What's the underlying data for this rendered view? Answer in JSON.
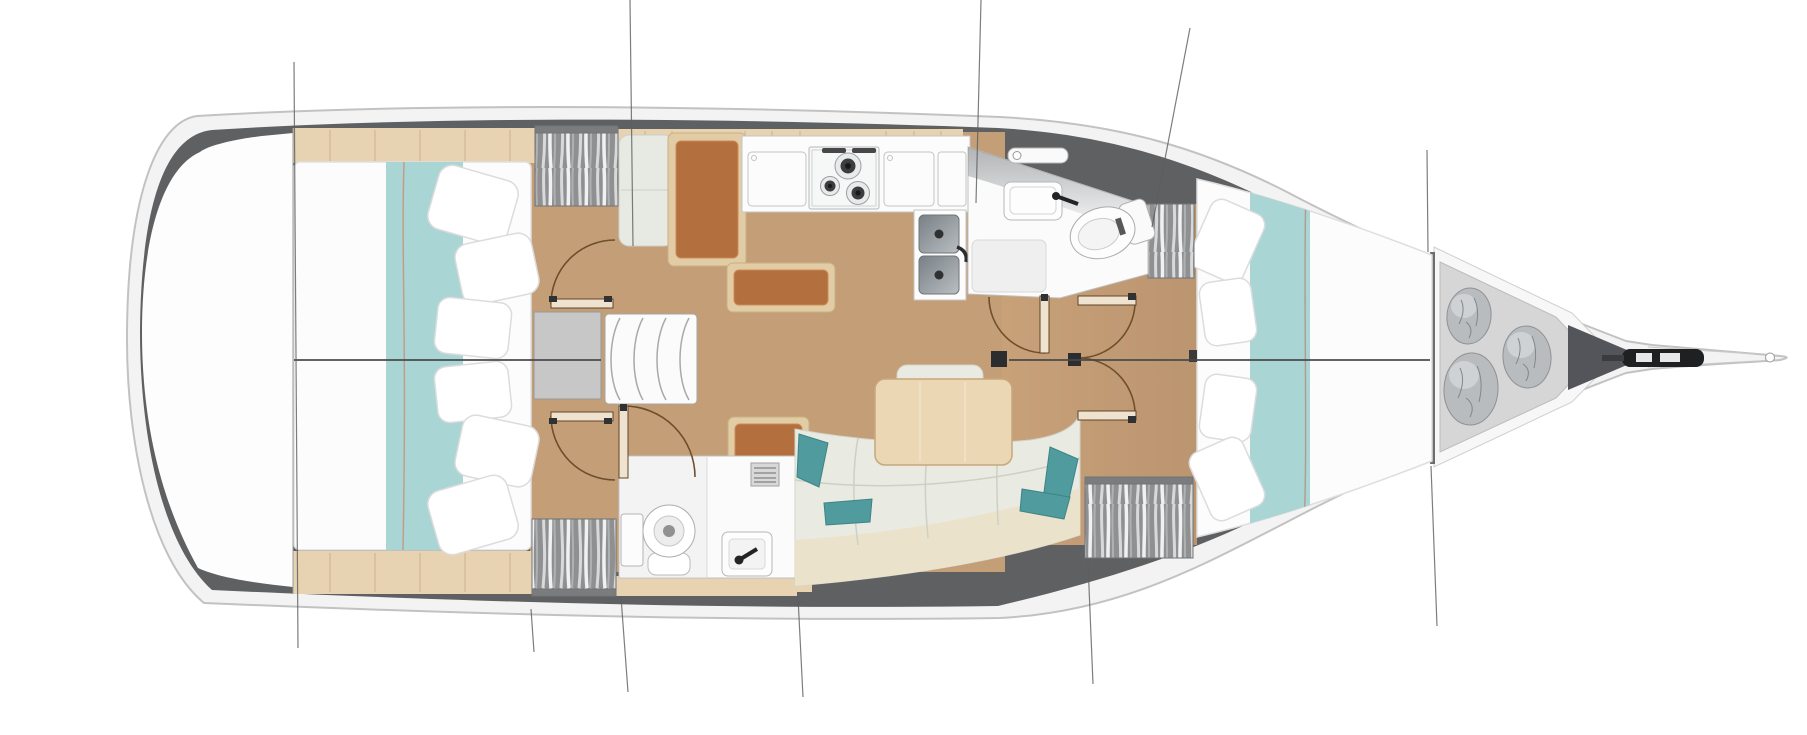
{
  "description": "Top-down interior floor plan of a sailing yacht, bow pointing right, no text labels visible",
  "colors": {
    "background": "#ffffff",
    "deck_band": "#f3f3f3",
    "deck_outline": "#c2c2c2",
    "gunwale_dark": "#5e6062",
    "interior_white": "#fdfdfd",
    "floor_wood": "#c49e77",
    "trim_wood": "#e7d2b1",
    "trim_seam": "#cdb38c",
    "mattress": "#fcfcfc",
    "bed_runner_teal": "#a9d5d4",
    "runner_piping": "#c59a84",
    "wardrobe_gray": "#8e9092",
    "sofa_fabric": "#e9eae2",
    "sofa_base": "#ebe2cc",
    "pillow_teal": "#4f9b9e",
    "table_wood": "#ebd7b4",
    "seat_brown": "#b3703e",
    "seat_frame": "#e2cca6",
    "room_white": "#fbfbfb",
    "desk_gray": "#c7c7c7",
    "steel": "#82898e",
    "hardware_dark": "#2b2d2f",
    "line_dark": "#5b5d5f",
    "locker_floor": "#d6d6d6",
    "fender_bag": "#b9bcbe"
  },
  "inventory": {
    "aft_double_beds": 2,
    "forward_double_beds": 1,
    "bathrooms": 2,
    "toilets": 2,
    "bathroom_sinks": 2,
    "galley_sinks": 2,
    "stove_burners": 3,
    "companionway_steps": 3,
    "wardrobes": 4,
    "door_swings": 6,
    "fender_bags": 3,
    "dining_tables": 1,
    "sofas": 1,
    "nav_desk": 1,
    "mast_steps": 1,
    "anchor_rollers": 1,
    "deck_hatches": 1
  },
  "rooms": [
    {
      "id": "aft-cabin-port",
      "kind": "cabin"
    },
    {
      "id": "aft-cabin-starboard",
      "kind": "cabin"
    },
    {
      "id": "salon",
      "kind": "living"
    },
    {
      "id": "galley",
      "kind": "kitchen"
    },
    {
      "id": "head-forward",
      "kind": "bathroom"
    },
    {
      "id": "head-aft",
      "kind": "bathroom"
    },
    {
      "id": "forward-cabin",
      "kind": "cabin"
    },
    {
      "id": "anchor-locker",
      "kind": "storage"
    },
    {
      "id": "stern-lazarette",
      "kind": "storage"
    }
  ]
}
